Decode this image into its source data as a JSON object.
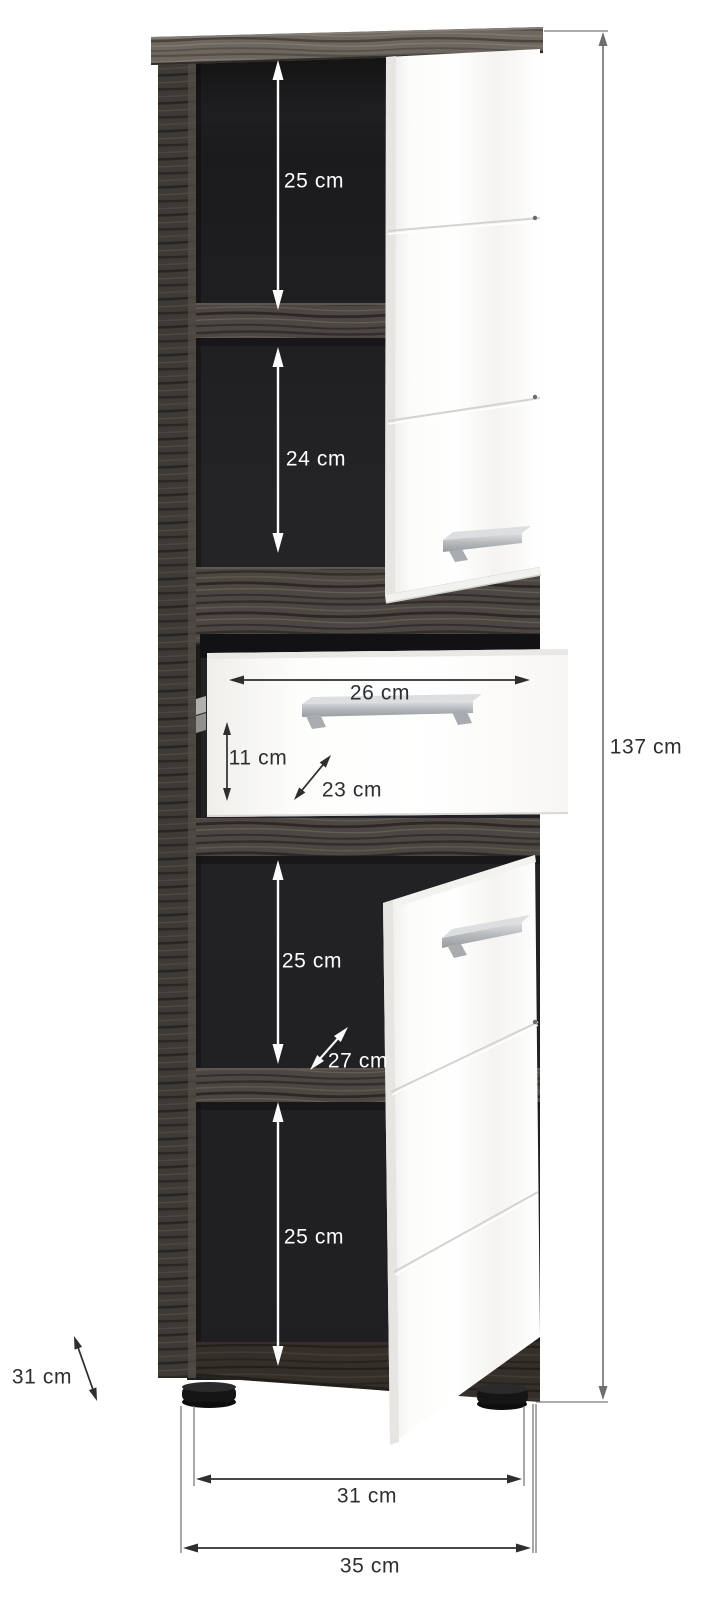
{
  "unit": "cm",
  "dims": {
    "top_compartment_height": "25 cm",
    "second_compartment_height": "24 cm",
    "drawer_inner_width": "26 cm",
    "drawer_front_height": "11 cm",
    "drawer_depth": "23 cm",
    "total_height": "137 cm",
    "third_compartment_height": "25 cm",
    "shelf_depth": "27 cm",
    "bottom_compartment_height": "25 cm",
    "body_depth": "31 cm",
    "feet_distance": "31 cm",
    "total_width": "35 cm"
  },
  "colors": {
    "body_wood": "#4c4742",
    "body_wood_top": "#6d675f",
    "interior": "#1e1e20",
    "front_gloss_white": "#ffffff",
    "handle_silver": "#b7babc",
    "annotation_on_dark": "#ffffff",
    "annotation_on_light": "#2e2e30",
    "feet_black": "#151515"
  }
}
